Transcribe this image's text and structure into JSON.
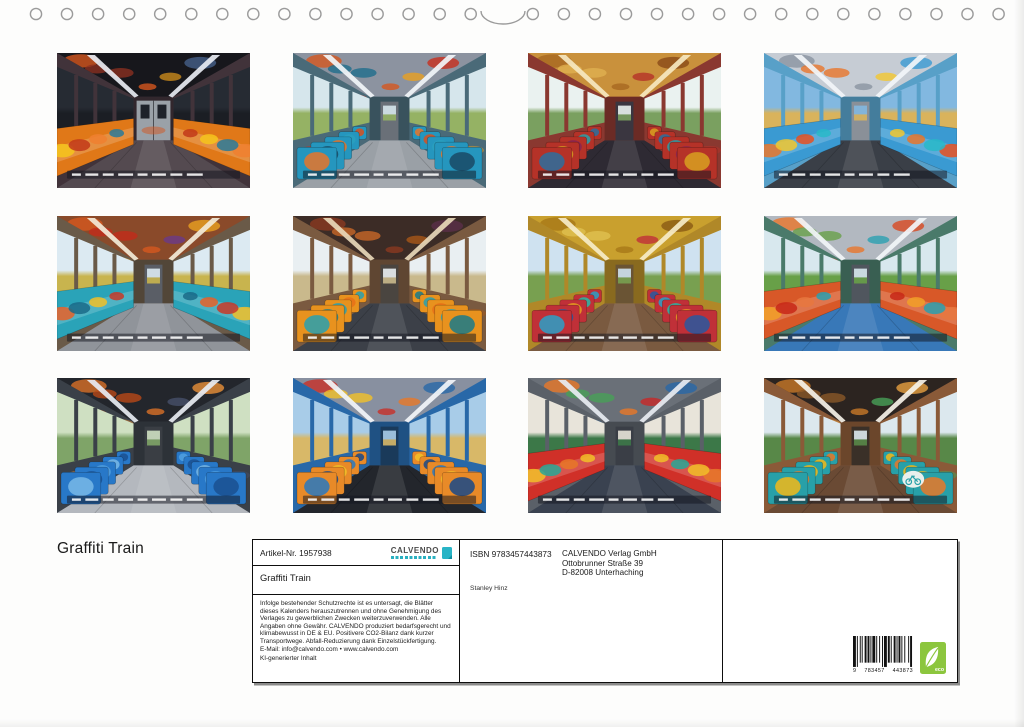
{
  "binding": {
    "ring_count": 32,
    "ring_color": "#9b9b9b",
    "hanger_center_x": 503,
    "hanger_width": 44
  },
  "grid": {
    "watermark_strip": true,
    "items": [
      {
        "name": "thumb-graffiti-subway-orange-benches",
        "type": "bench",
        "special": "subwayDoors",
        "ceiling": "#17171c",
        "ceilingAccents": [
          "#d4561e",
          "#8a2f20",
          "#46608a",
          "#c98a1c"
        ],
        "wall": "#41333a",
        "windowSky": "#262b33",
        "windowGround": "#1b1e24",
        "seatMain": "#e07818",
        "seatAccents": [
          "#f6c61c",
          "#c23a1a",
          "#f08030",
          "#2a7a9a"
        ],
        "floor": "#544a50",
        "door": "#9aa1a8",
        "light": "#e8ecf2"
      },
      {
        "name": "thumb-graffiti-coach-blue-rows",
        "type": "rows",
        "ceiling": "#8c93a0",
        "ceilingAccents": [
          "#d4581f",
          "#1f6e8c",
          "#c8301e",
          "#e8a020"
        ],
        "wall": "#4a6a78",
        "windowSky": "#d6e6ec",
        "windowGround": "#95b264",
        "seatMain": "#2596be",
        "seatAccents": [
          "#e8762a",
          "#1a4a66",
          "#e8762a",
          "#2aa0c0",
          "#d85020"
        ],
        "floor": "#9aa0a6",
        "door": "#6a7078",
        "light": "#f2f5f8"
      },
      {
        "name": "thumb-graffiti-coach-golden-red",
        "type": "rows",
        "ceiling": "#c9913c",
        "ceilingAccents": [
          "#a86820",
          "#e0b050",
          "#8a4a18",
          "#b53228"
        ],
        "wall": "#8a3830",
        "windowSky": "#eaf2f0",
        "windowGround": "#7aa060",
        "seatMain": "#b53228",
        "seatAccents": [
          "#2b6e9e",
          "#d8a020",
          "#8a2450",
          "#2aa0a8"
        ],
        "floor": "#2e2a33",
        "door": "#3a3640",
        "light": "#f6e8c0"
      },
      {
        "name": "thumb-graffiti-coach-bright-benches",
        "type": "bench",
        "ceiling": "#c6ccd4",
        "ceilingAccents": [
          "#8a93a0",
          "#e8762a",
          "#3a9ad2",
          "#f2c72e"
        ],
        "wall": "#58a0c8",
        "windowSky": "#82b8e0",
        "windowGround": "#d9b35c",
        "seatMain": "#3a9ad2",
        "seatAccents": [
          "#e8762a",
          "#f2c72e",
          "#e85020",
          "#28b8c8"
        ],
        "floor": "#3a3f47",
        "door": "#8a9098",
        "light": "#f2f5f8"
      },
      {
        "name": "thumb-graffiti-coach-teal-benches",
        "type": "bench",
        "ceiling": "#8a4a2a",
        "ceilingAccents": [
          "#d4581f",
          "#c22a1a",
          "#e8a020",
          "#6a3a88"
        ],
        "wall": "#6a5a48",
        "windowSky": "#dceaf2",
        "windowGround": "#c8b44e",
        "seatMain": "#2aa3b8",
        "seatAccents": [
          "#e86028",
          "#1a6a88",
          "#f2c028",
          "#c83828"
        ],
        "floor": "#90949a",
        "door": "#5a5e66",
        "light": "#f2ead8"
      },
      {
        "name": "thumb-graffiti-coach-orange-teal-rows",
        "type": "rows",
        "ceiling": "#3c2c26",
        "ceilingAccents": [
          "#8a3a20",
          "#c86828",
          "#5a3048",
          "#a85818"
        ],
        "wall": "#7a5a40",
        "windowSky": "#e9eff2",
        "windowGround": "#c9b98c",
        "seatMain": "#e8921e",
        "seatAccents": [
          "#28a0b0",
          "#1a7a8a",
          "#28a0b0",
          "#e87018"
        ],
        "floor": "#3c4048",
        "door": "#4a4540",
        "light": "#e8d8b8"
      },
      {
        "name": "thumb-graffiti-coach-yellow-red-rows",
        "type": "rows",
        "ceiling": "#c9a02e",
        "ceilingAccents": [
          "#a87818",
          "#e0c050",
          "#8a5a14",
          "#c03038"
        ],
        "wall": "#b08828",
        "windowSky": "#cfe2f0",
        "windowGround": "#78a050",
        "seatMain": "#c03038",
        "seatAccents": [
          "#2aa0c8",
          "#2858a0",
          "#e8a020",
          "#28b8a8"
        ],
        "floor": "#7a5a40",
        "door": "#6a5434",
        "light": "#f6ecc8"
      },
      {
        "name": "thumb-graffiti-coach-blue-floor-benches",
        "type": "bench",
        "ceiling": "#b2b8c0",
        "ceilingAccents": [
          "#e8762a",
          "#68a048",
          "#d84820",
          "#2aa0b0"
        ],
        "wall": "#4a7a6a",
        "windowSky": "#d8e8ee",
        "windowGround": "#68a048",
        "seatMain": "#d85828",
        "seatAccents": [
          "#f2a028",
          "#c82818",
          "#e87840",
          "#2aa0b0"
        ],
        "floor": "#3878b8",
        "door": "#50565e",
        "light": "#f2f5f8"
      },
      {
        "name": "thumb-graffiti-coach-blue-seat-rows",
        "type": "rows",
        "ceiling": "#23262c",
        "ceilingAccents": [
          "#d87028",
          "#b84818",
          "#e89038",
          "#46506a"
        ],
        "wall": "#3a4048",
        "windowSky": "#cfe0c2",
        "windowGround": "#7fa468",
        "seatMain": "#2878c8",
        "seatAccents": [
          "#78b8e8",
          "#1a5090",
          "#50a0e0"
        ],
        "floor": "#b4b8be",
        "door": "#3a3e44",
        "light": "#e8ecf2"
      },
      {
        "name": "thumb-graffiti-coach-orange-blue-rows",
        "type": "rows",
        "ceiling": "#8890a0",
        "ceilingAccents": [
          "#c83028",
          "#f2c028",
          "#2868a8",
          "#e87828"
        ],
        "wall": "#2868a8",
        "windowSky": "#a8cce8",
        "windowGround": "#d8b868",
        "seatMain": "#e88a28",
        "seatAccents": [
          "#2878c0",
          "#184888",
          "#f2c028"
        ],
        "floor": "#23262c",
        "door": "#1a3a5a",
        "light": "#f2f5f8"
      },
      {
        "name": "thumb-graffiti-coach-multicolor-benches",
        "type": "bench",
        "ceiling": "#6a7078",
        "ceilingAccents": [
          "#e87828",
          "#48a058",
          "#2868a8",
          "#c82828"
        ],
        "wall": "#5a6068",
        "windowSky": "#e8e4da",
        "windowGround": "#3c7848",
        "seatMain": "#d03028",
        "seatAccents": [
          "#f2c028",
          "#28a898",
          "#e87828",
          "#f2c028",
          "#28a898"
        ],
        "floor": "#3a4250",
        "door": "#3a3e46",
        "light": "#e8ecf2"
      },
      {
        "name": "thumb-graffiti-coach-teal-yellow-bike",
        "type": "rows",
        "special": "bike",
        "ceiling": "#2c2420",
        "ceilingAccents": [
          "#c87828",
          "#8a5828",
          "#e8a040",
          "#48a058"
        ],
        "wall": "#8a5a38",
        "windowSky": "#dce8ee",
        "windowGround": "#588848",
        "seatMain": "#28a0a8",
        "seatAccents": [
          "#f2b818",
          "#e87828",
          "#f2b818"
        ],
        "floor": "#6a4a34",
        "door": "#3a3028",
        "light": "#f6f2e8"
      }
    ]
  },
  "footer": {
    "page_title": "Graffiti Train",
    "info_box": {
      "article_no": "Artikel-Nr. 1957938",
      "brand": "CALVENDO",
      "title": "Graffiti Train",
      "legal": "Infolge bestehender Schutzrechte ist es untersagt, die Blätter dieses Kalenders herauszutrennen und ohne Genehmigung des Verlages zu gewerblichen Zwecken weiterzuverwenden. Alle Angaben ohne Gewähr. CALVENDO produziert bedarfsgerecht und klimabewusst in DE & EU. Positivere CO2-Bilanz dank kurzer Transportwege. Abfall-Reduzierung dank Einzelstückfertigung.",
      "email_line": "E-Mail: info@calvendo.com • www.calvendo.com",
      "ai_note": "KI-generierter Inhalt",
      "isbn": "ISBN 9783457443873",
      "publisher_lines": [
        "CALVENDO Verlag GmbH",
        "Ottobrunner Straße 39",
        "D-82008 Unterhaching"
      ],
      "author": "Stanley Hinz",
      "barcode_digits": [
        "9",
        "783457",
        "443873"
      ],
      "eco_label": "eco",
      "eco_color": "#8cc63e",
      "brand_color": "#29b4c6"
    }
  }
}
